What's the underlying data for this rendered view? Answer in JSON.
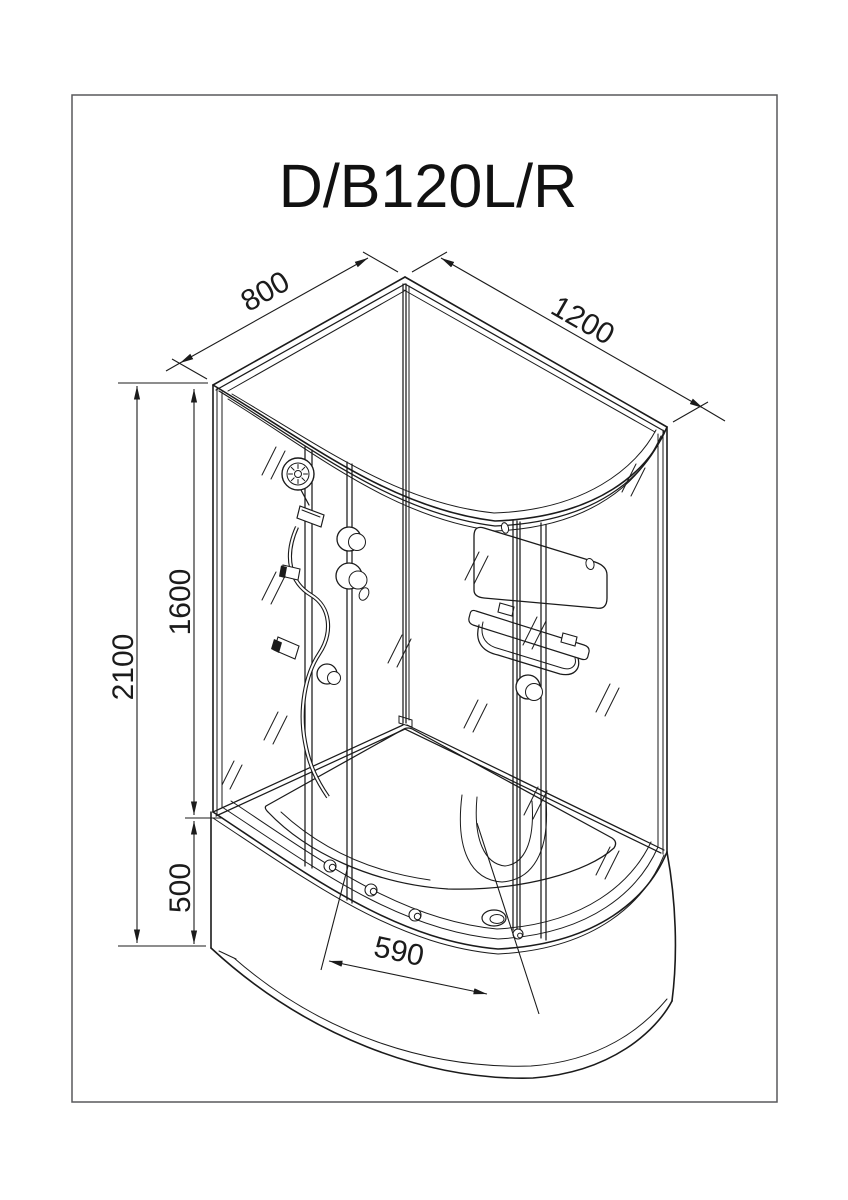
{
  "title": "D/B120L/R",
  "drawing": {
    "dimensions": {
      "depth_top": "800",
      "width_top": "1200",
      "height_total": "2100",
      "height_glass": "1600",
      "height_tray": "500",
      "door_opening": "590"
    },
    "colors": {
      "line": "#1b1b1b",
      "page_border": "#58595b",
      "background": "#ffffff"
    }
  }
}
